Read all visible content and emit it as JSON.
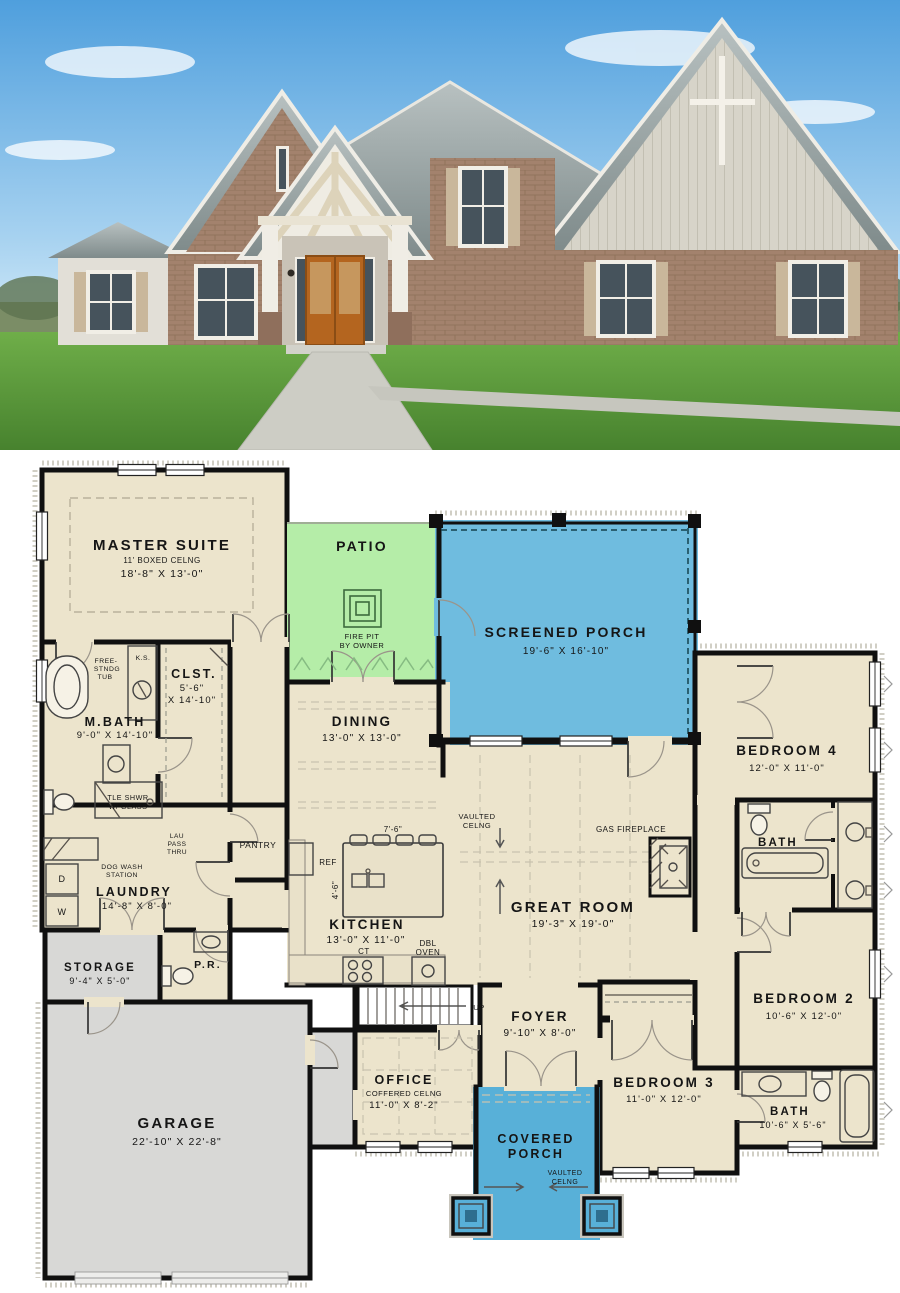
{
  "palette": {
    "floor": "#ece4cc",
    "patio": "#b5eda8",
    "screened_porch": "#6fbcdf",
    "covered_porch": "#58b0d8",
    "garage": "#d8d8d6",
    "walls": "#101010",
    "photo": {
      "sky": "#5ea9e0",
      "sky_light": "#cfe7f7",
      "grass": "#5f9e3d",
      "roof": "#9aa4a4",
      "brick": "#a3826d",
      "siding": "#d7d4c9",
      "trim": "#f1eee6",
      "door": "#b4651f",
      "shutters": "#c9b79b",
      "glass": "#46535c"
    }
  },
  "rooms": {
    "master": {
      "name": "MASTER SUITE",
      "ceil": "11' BOXED CELNG",
      "dims": "18'-8\" X 13'-0\""
    },
    "patio": {
      "name": "PATIO"
    },
    "firepit": {
      "l1": "FIRE PIT",
      "l2": "BY OWNER"
    },
    "sporch": {
      "name": "SCREENED PORCH",
      "dims": "19'-6\" X 16'-10\""
    },
    "dining": {
      "name": "DINING",
      "dims": "13'-0\" X 13'-0\""
    },
    "kitchen": {
      "name": "KITCHEN",
      "dims": "13'-0\" X 11'-0\""
    },
    "great": {
      "name": "GREAT ROOM",
      "dims": "19'-3\" X 19'-0\""
    },
    "mbath": {
      "name": "M.BATH",
      "dims": "9'-0\" X 14'-10\""
    },
    "clst": {
      "name": "CLST.",
      "d1": "5'-6\"",
      "d2": "X 14'-10\""
    },
    "pantry": {
      "name": "PANTRY"
    },
    "laundry": {
      "name": "LAUNDRY",
      "dims": "14'-8\" X 8'-0\""
    },
    "pr": {
      "name": "P.R."
    },
    "storage": {
      "name": "STORAGE",
      "dims": "9'-4\" X 5'-0\""
    },
    "garage": {
      "name": "GARAGE",
      "dims": "22'-10\" X 22'-8\""
    },
    "foyer": {
      "name": "FOYER",
      "dims": "9'-10\" X 8'-0\""
    },
    "office": {
      "name": "OFFICE",
      "ceil": "COFFERED CELNG",
      "dims": "11'-0\" X 8'-2\""
    },
    "cporch": {
      "n1": "COVERED",
      "n2": "PORCH",
      "c1": "VAULTED",
      "c2": "CELNG"
    },
    "bed4": {
      "name": "BEDROOM 4",
      "dims": "12'-0\" X 11'-0\""
    },
    "bath4": {
      "name": "BATH"
    },
    "bed2": {
      "name": "BEDROOM 2",
      "dims": "10'-6\" X 12'-0\""
    },
    "bed3": {
      "name": "BEDROOM 3",
      "dims": "11'-0\" X 12'-0\""
    },
    "bath2": {
      "name": "BATH",
      "dims": "10'-6\" X 5'-6\""
    }
  },
  "ann": {
    "free1": "FREE-",
    "free2": "STNDG",
    "free3": "TUB",
    "ks": "K.S.",
    "shwr1": "TLE SHWR",
    "shwr2": "W/ GLASS",
    "lau1": "LAU",
    "lau2": "PASS",
    "lau3": "THRU",
    "dog1": "DOG WASH",
    "dog2": "STATION",
    "vault1": "VAULTED",
    "vault2": "CELNG",
    "gasfp": "GAS FIREPLACE",
    "ref": "REF",
    "ct": "CT",
    "dbl1": "DBL",
    "dbl2": "OVEN",
    "islw": "7'-6\"",
    "isld": "4'-6\"",
    "up": "UP",
    "w": "W",
    "d": "D"
  }
}
